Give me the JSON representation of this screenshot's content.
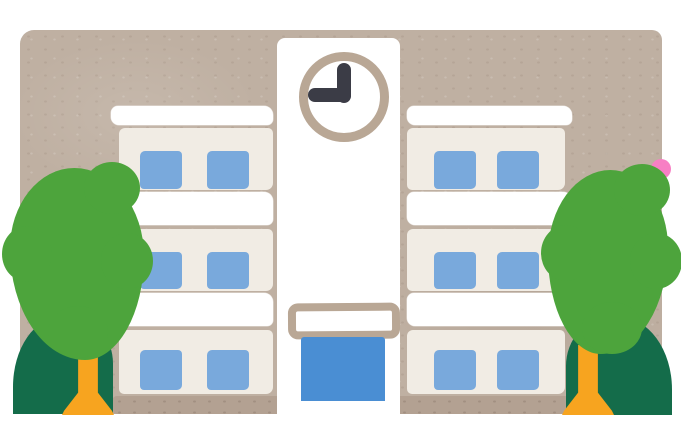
{
  "meta": {
    "type": "illustration",
    "subject": "Watercolor clipart of a white three-story school building with a central clock tower, blue windows, a blue entrance door, and a green tree on each side",
    "text_content": "none"
  },
  "colors": {
    "page_margin": "#ffffff",
    "background": "#bfb0a2",
    "building_white": "#ffffff",
    "building_wall": "#f1ece4",
    "trim_tan": "#b3a192",
    "window_blue": "#79a9dc",
    "door_blue": "#4a8ed3",
    "clock_ring": "#b9a795",
    "clock_hands": "#3b3c46",
    "tree_canopy_green": "#4da43c",
    "tree_bush_green": "#146c4a",
    "tree_trunk_orange": "#f7a41f",
    "blossom_pink": "#f77fc4"
  },
  "building": {
    "floors": 3,
    "wings": [
      "left",
      "right"
    ],
    "windows_per_floor_per_wing": 2,
    "clock": {
      "time_shown": "9:00",
      "hour_hand_points": "9",
      "minute_hand_points": "12"
    },
    "entrance": {
      "sign_above_door": true,
      "door_color_name": "blue"
    }
  },
  "trees": [
    {
      "position": "left",
      "parts": [
        "round green canopy",
        "orange flared trunk",
        "dark green bush"
      ]
    },
    {
      "position": "right",
      "parts": [
        "round green canopy",
        "orange flared trunk",
        "dark green bush"
      ]
    }
  ],
  "blossom": {
    "position": "right edge, partially hidden by tree canopy"
  }
}
